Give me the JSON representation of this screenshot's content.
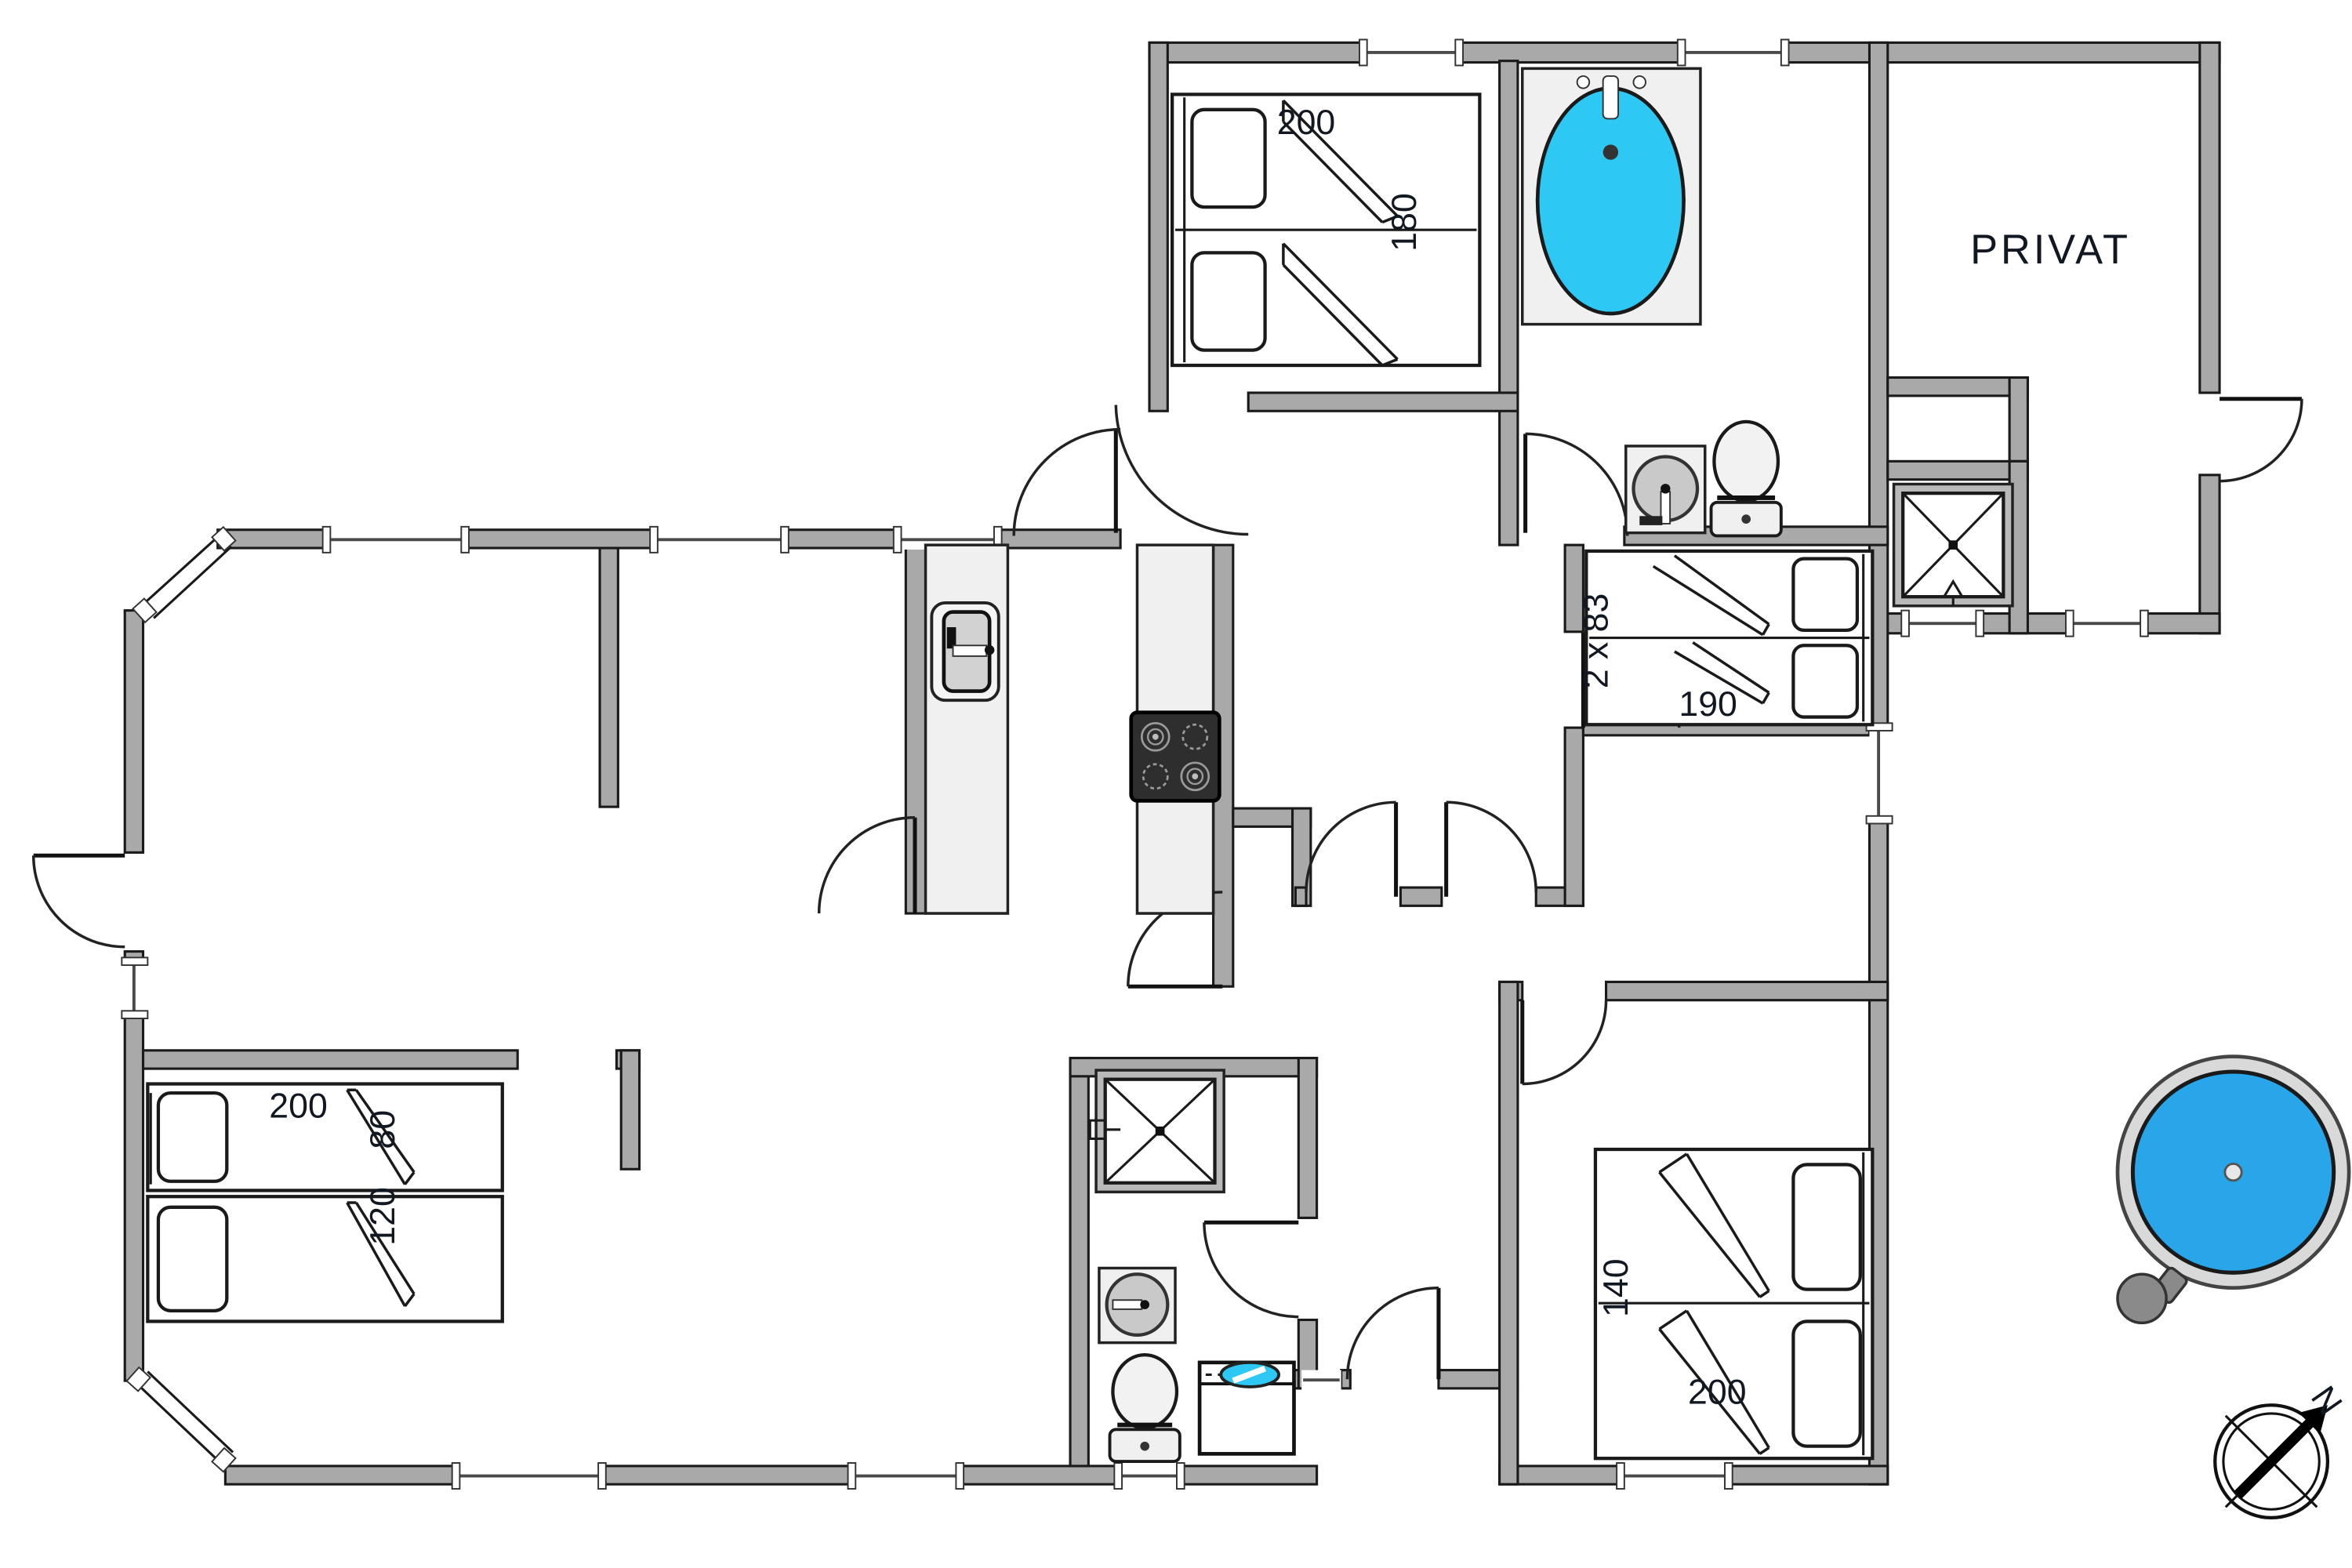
{
  "document": {
    "kind": "floor-plan",
    "background": "#ffffff"
  },
  "colors": {
    "wall": "#a9a9a9",
    "wall_outline": "#1a1a1a",
    "fixture_light": "#f0f0f0",
    "bathtub_water": "#2ec8f4",
    "hot_tub_water": "#29a5e9",
    "washer_accent": "#2ec8f4",
    "stove": "#2e2e2e",
    "label_text": "#121822"
  },
  "rooms": {
    "privat": {
      "label": "PRIVAT"
    }
  },
  "dimensions": {
    "top_bedroom_bed": {
      "length": "200",
      "width": "180"
    },
    "middle_bedroom_bed": {
      "mattresses": "2 x 83",
      "length": "190"
    },
    "left_bedroom_beds": {
      "length": "200",
      "upper_width": "80",
      "lower_width": "120"
    },
    "right_bedroom_bed": {
      "width": "140",
      "length": "200"
    }
  },
  "compass": {
    "north": "N"
  },
  "fixtures": [
    "double-bed",
    "single-bed",
    "bathtub",
    "washbasin",
    "toilet",
    "shower",
    "kitchen-sink",
    "stove-cooktop",
    "washing-machine",
    "hot-tub",
    "compass-rose"
  ]
}
